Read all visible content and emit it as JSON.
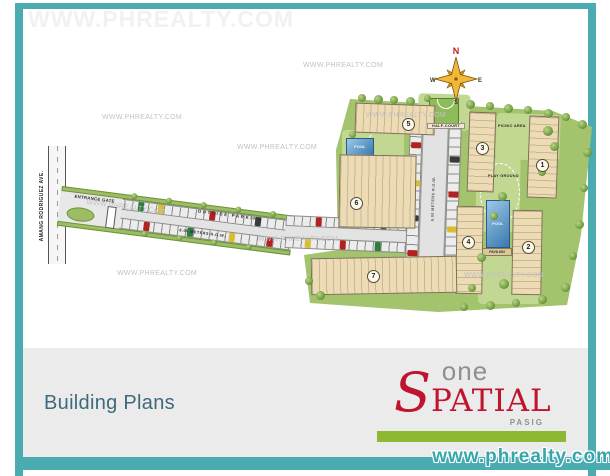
{
  "watermark": {
    "text": "WWW.PHREALTY.COM",
    "url": "www.phrealty.com"
  },
  "footer": {
    "title": "Building Plans"
  },
  "logo": {
    "one": "one",
    "s": "S",
    "patial": "PATIAL",
    "city": "PASIG"
  },
  "compass": {
    "n": "N",
    "e": "E",
    "s": "S",
    "w": "W"
  },
  "site": {
    "roads": {
      "avenue": "AMANG RODRIGUEZ AVE.",
      "entrance_gate": "ENTRANCE GATE",
      "outside_parking": "OUTSIDE PARKING",
      "outside_row": "8.00 METERS R.O.W.",
      "inner_row": "6.00 METERS R.O.W."
    },
    "amenities": {
      "half_court": "HALF-COURT",
      "picnic_area": "PICNIC AREA",
      "play_ground": "PLAY GROUND",
      "pool_top": "POOL",
      "pool_bottom": "POOL",
      "pavilion": "PAVILION"
    },
    "buildings": [
      {
        "num": "1"
      },
      {
        "num": "2"
      },
      {
        "num": "3"
      },
      {
        "num": "4"
      },
      {
        "num": "5"
      },
      {
        "num": "6"
      },
      {
        "num": "7"
      }
    ]
  },
  "colors": {
    "frame_teal": "#4aabb1",
    "footer_gray": "#ebebeb",
    "site_green": "#a3c36c",
    "building_beige": "#ecdbb4",
    "pool_blue": "#3a79ad",
    "title_slate": "#3d6a7c",
    "logo_red": "#c0142e",
    "logo_gray": "#8f8f8f",
    "logo_green_bar": "#8cb832",
    "url_teal": "#35a6ab",
    "compass_gold": "#f0b93a"
  }
}
